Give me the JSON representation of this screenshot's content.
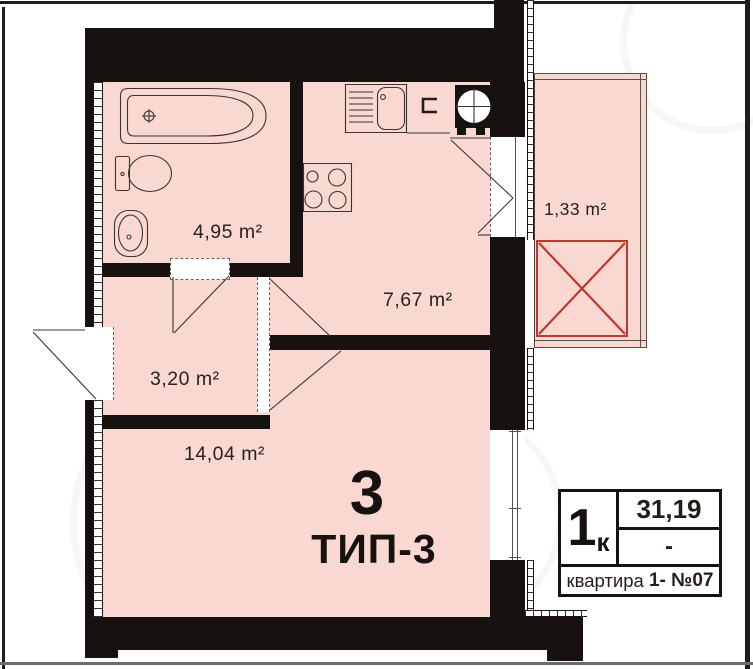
{
  "plan": {
    "type_number": "3",
    "type_name": "ТИП-3",
    "rooms": {
      "bathroom": {
        "name": "bathroom",
        "area": "4,95 m²"
      },
      "kitchen": {
        "name": "kitchen-living",
        "area": "7,67 m²"
      },
      "hall": {
        "name": "hallway",
        "area": "3,20 m²"
      },
      "living": {
        "name": "living-room",
        "area": "14,04 m²"
      },
      "balcony": {
        "name": "balcony",
        "area": "1,33 m²"
      }
    },
    "stamp": {
      "rooms_count": "1",
      "rooms_unit": "к",
      "total_area": "31,19",
      "second_value": "-",
      "apartment_word": "квартира ",
      "apartment_value": "1- ",
      "apartment_number": "№07"
    },
    "colors": {
      "room_fill": "#f8d8d1",
      "wall": "#17120f",
      "balcony_cross_red": "#c0372e"
    },
    "fixtures": [
      "bathtub",
      "toilet",
      "wash-basin",
      "kitchen-sink",
      "cooktop",
      "washing-machine"
    ]
  }
}
